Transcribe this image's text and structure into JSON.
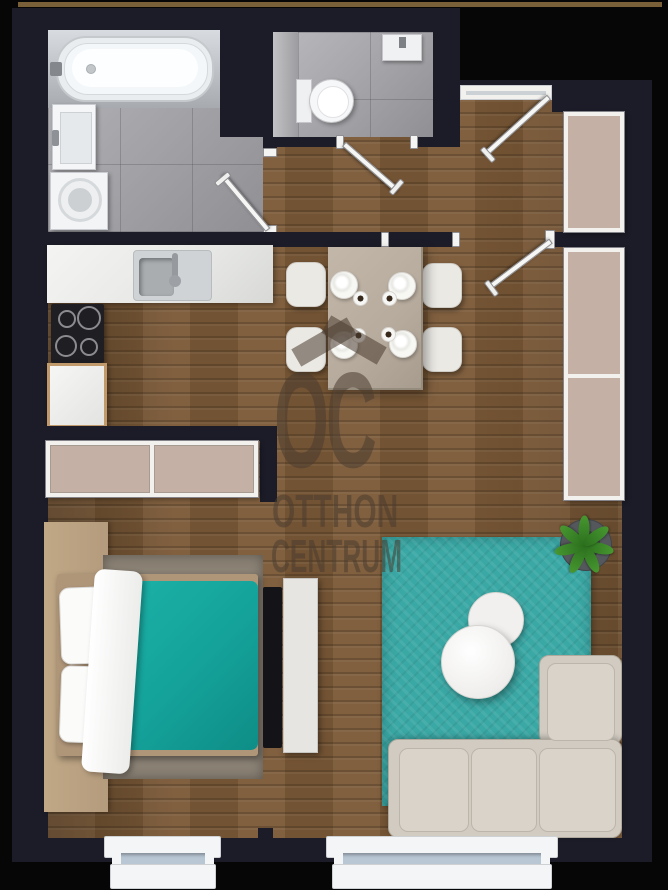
{
  "watermark": {
    "logo": "OC",
    "line1": "OTTHON",
    "line2": "CENTRUM"
  },
  "colors": {
    "outside": "#060607",
    "wall": "#1c1c28",
    "topline": "#7a6038",
    "wood": "#7b5937",
    "tile": "#a2a2a6",
    "tile_strip": "#b6b6b9",
    "counter": "#e7e8e6",
    "beige": "#c4b0a4",
    "frame_white": "#f2f1ee",
    "teal_rug": "#3aa8a5",
    "teal_bed": "#14a29a",
    "sofa": "#d1cbc2",
    "sofa_cushion": "#d9d3ca",
    "table": "#b7ab9d",
    "chair": "#ebe9e4",
    "bed_rug": "#8b8275",
    "tan": "#b49b7d",
    "wm": "rgba(74,61,47,0.55)",
    "glass": "#b9c6d4",
    "plant": "#479730",
    "pot": "#54585c",
    "tv": "#141418",
    "cooktop": "#1f1f23"
  }
}
